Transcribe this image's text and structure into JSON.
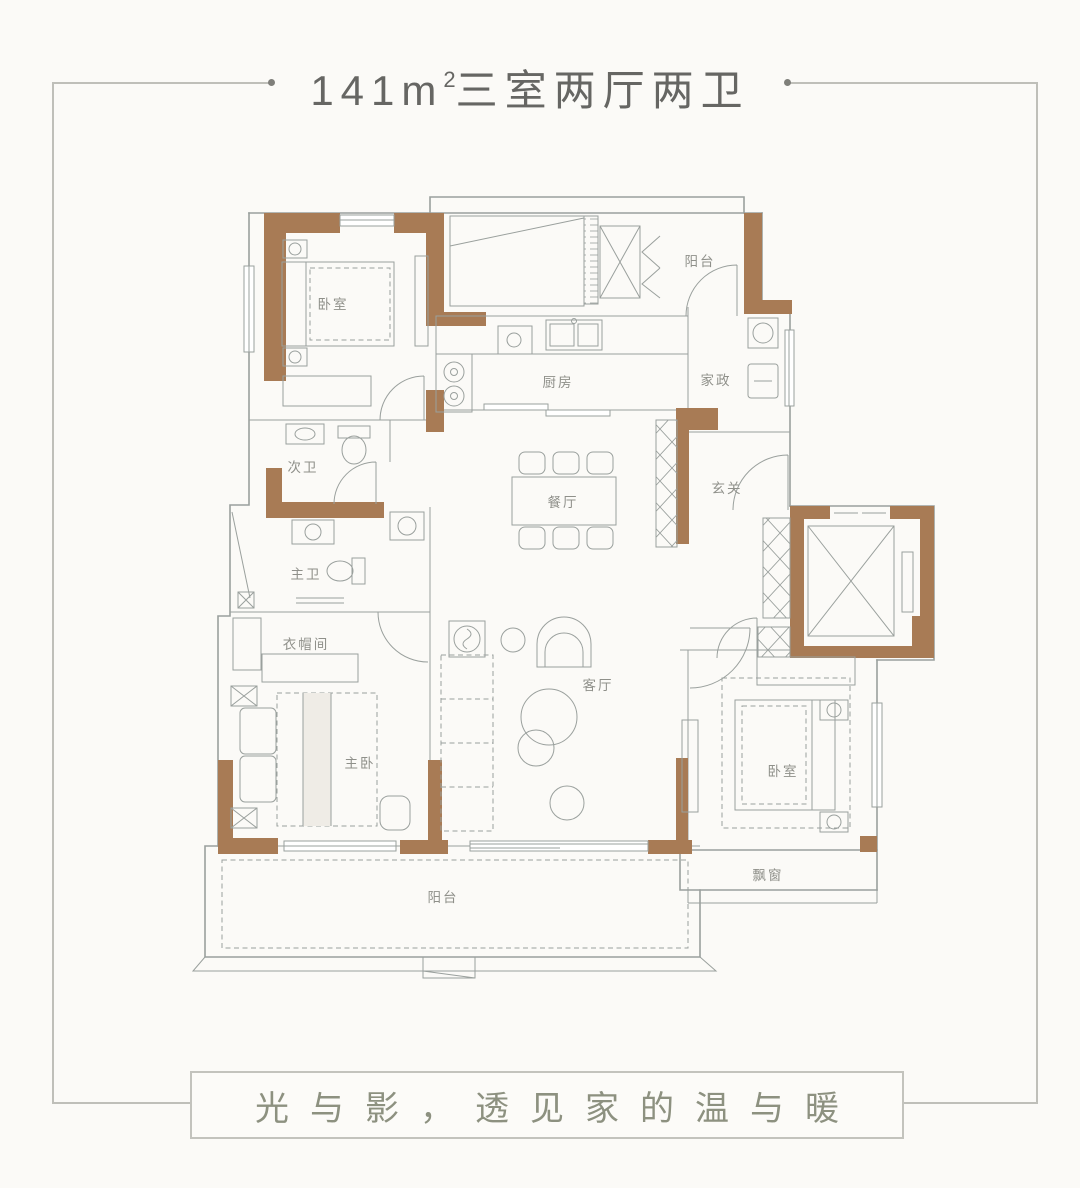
{
  "header": {
    "area_value": "141m",
    "area_sup": "2",
    "rooms_text": "三室两厅两卫"
  },
  "plan": {
    "labels": {
      "bedroom_tl": "卧室",
      "balcony_top": "阳台",
      "kitchen": "厨房",
      "laundry": "家政",
      "bath_second": "次卫",
      "foyer": "玄关",
      "dining": "餐厅",
      "bath_master": "主卫",
      "closet": "衣帽间",
      "living": "客厅",
      "bedroom_master": "主卧",
      "bedroom_right": "卧室",
      "bay_window": "飘窗",
      "balcony_bottom": "阳台"
    }
  },
  "footer": {
    "tagline": "光与影，透见家的温与暖"
  },
  "colors": {
    "wall_brown": "#a87b55",
    "plan_line": "#9aa09d",
    "room_label": "#8f908a",
    "frame_line": "#bfbfb9",
    "title_text": "#666663",
    "tagline_text": "#8d9180",
    "background": "#fbfaf7"
  }
}
